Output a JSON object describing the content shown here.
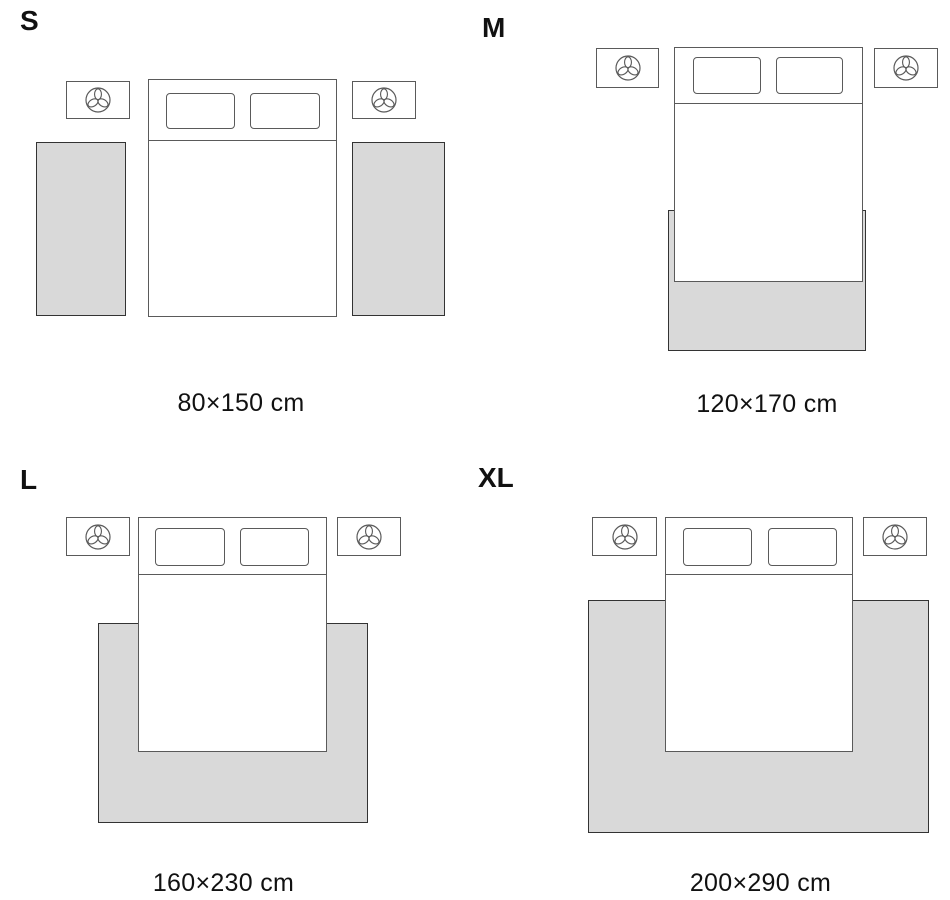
{
  "colors": {
    "background": "#ffffff",
    "rug_fill": "#d9d9d9",
    "rug_outline": "#333333",
    "furniture_outline": "#5a5a5a",
    "text": "#111111"
  },
  "icons": {
    "nightstand_icon": "plant-icon"
  },
  "sizes": [
    {
      "label": "S",
      "caption": "80×150 cm",
      "rug_placement": "two runner rugs, one on each side of the bed"
    },
    {
      "label": "M",
      "caption": "120×170 cm",
      "rug_placement": "rug under the foot of the bed"
    },
    {
      "label": "L",
      "caption": "160×230 cm",
      "rug_placement": "rug under the lower part of the bed, extending on both sides"
    },
    {
      "label": "XL",
      "caption": "200×290 cm",
      "rug_placement": "large rug under most of the bed, extending wide on both sides"
    }
  ]
}
